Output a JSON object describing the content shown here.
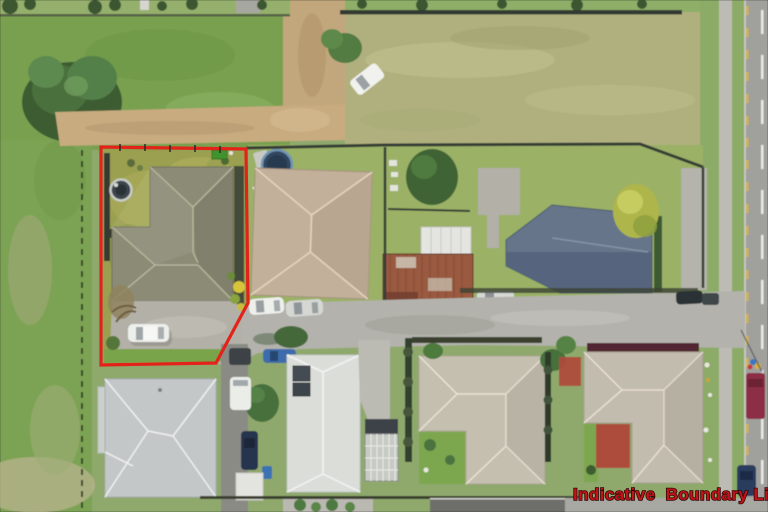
{
  "overlay": {
    "boundary_label": "Indicative  Boundary Line"
  },
  "colors": {
    "boundary_red": "#e3221a",
    "label_fill": "#c01418",
    "label_outline": "#330608"
  },
  "scene": {
    "view": "aerial-photo",
    "subject_property_features": [
      "yellow-green-lawn",
      "grey-tile-hip-roof-house",
      "round-spa-pool",
      "green-garden-shed",
      "concrete-driveway",
      "parked-white-car",
      "dark-boundary-fence"
    ],
    "surroundings": [
      "green-paddock",
      "large-tree",
      "dirt-track",
      "mown-tan-field",
      "white-ute-in-field",
      "above-ground-pool",
      "white-shade-sail",
      "tan-hip-roof-house",
      "white-garage",
      "rusty-corrugated-roof",
      "blue-grey-steel-roof-house",
      "yellow-green-tree",
      "middle-street",
      "parked-cars",
      "light-grey-hip-roof-house",
      "white-roof-house-with-solar-panels",
      "glasshouse",
      "two-beige-hip-roof-houses",
      "red-paved-patio",
      "grass-verge",
      "footpath",
      "road-with-dashed-centerline",
      "maroon-vehicle",
      "dark-blue-car"
    ]
  }
}
